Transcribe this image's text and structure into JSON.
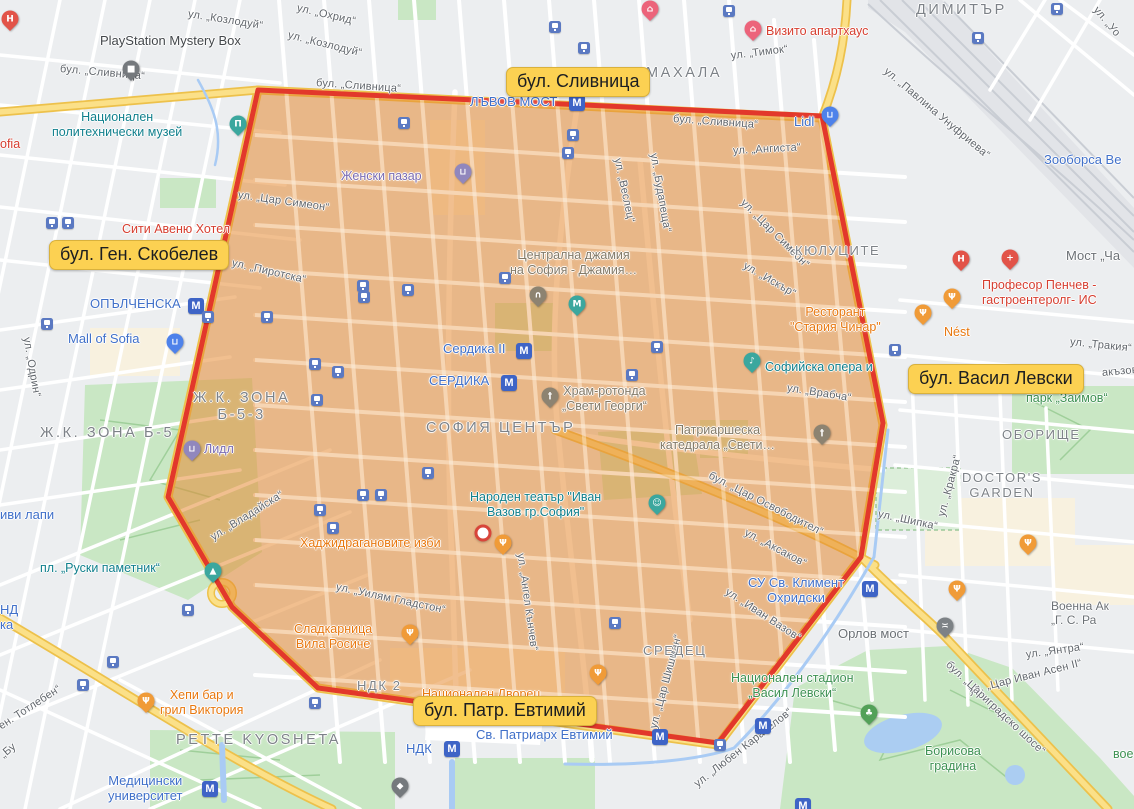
{
  "annotations": [
    {
      "id": "slivnitsa",
      "label": "бул. Сливница",
      "x": 506,
      "y": 67
    },
    {
      "id": "skobelev",
      "label": "бул. Ген. Скобелев",
      "x": 49,
      "y": 240
    },
    {
      "id": "vasil-levski",
      "label": "бул. Васил Левски",
      "x": 908,
      "y": 364
    },
    {
      "id": "patr-evtimiy",
      "label": "бул. Патр. Евтимий",
      "x": 413,
      "y": 696
    }
  ],
  "map": {
    "zone": {
      "points": "258,90 822,116 883,423 861,557 718,743 318,688 232,607 168,497",
      "fill": "rgba(230,139,51,0.55)",
      "stroke": "#e2382b",
      "stroke_width": 5
    },
    "marker": {
      "x": 483,
      "y": 533
    },
    "labels": [
      {
        "t": "ул. „Козлодуй“",
        "x": 188,
        "y": 8,
        "c": "st",
        "r": 9
      },
      {
        "t": "ул. „Козлодуй“",
        "x": 288,
        "y": 29,
        "c": "st",
        "r": 14
      },
      {
        "t": "ул. „Охрид“",
        "x": 297,
        "y": 2,
        "c": "st",
        "r": 13
      },
      {
        "t": "бул. „Сливница“",
        "x": 60,
        "y": 63,
        "c": "st",
        "r": 5
      },
      {
        "t": "бул. „Сливница“",
        "x": 316,
        "y": 77,
        "c": "st",
        "r": 4
      },
      {
        "t": "бул. „Сливница“",
        "x": 673,
        "y": 113,
        "c": "st",
        "r": 4
      },
      {
        "t": "ул. „Тимок“",
        "x": 731,
        "y": 50,
        "c": "st",
        "r": -7
      },
      {
        "t": "ул. „Павлина Унуфриева“",
        "x": 885,
        "y": 64,
        "c": "st",
        "r": 40
      },
      {
        "t": "ул. „Уо",
        "x": 1095,
        "y": 2,
        "c": "st",
        "r": 50
      },
      {
        "t": "ул. „Ангиста“",
        "x": 733,
        "y": 145,
        "c": "st",
        "r": -3
      },
      {
        "t": "ул. „Веслец“",
        "x": 617,
        "y": 152,
        "c": "st",
        "r": 78
      },
      {
        "t": "ул. „Будапеща“",
        "x": 653,
        "y": 147,
        "c": "st",
        "r": 80
      },
      {
        "t": "ул. „Цар Симеон“",
        "x": 238,
        "y": 189,
        "c": "st",
        "r": 8
      },
      {
        "t": "ул. „Цар Симеон“",
        "x": 742,
        "y": 195,
        "c": "st",
        "r": 45
      },
      {
        "t": "ул. „Пиротска“",
        "x": 232,
        "y": 257,
        "c": "st",
        "r": 13
      },
      {
        "t": "ул. „Одрин“",
        "x": 26,
        "y": 331,
        "c": "st",
        "r": 80
      },
      {
        "t": "ул. „Искър“",
        "x": 744,
        "y": 259,
        "c": "st",
        "r": 30
      },
      {
        "t": "ул. „Врабча“",
        "x": 787,
        "y": 382,
        "c": "st",
        "r": 9
      },
      {
        "t": "ул. „Тракия“",
        "x": 1070,
        "y": 336,
        "c": "st",
        "r": 6
      },
      {
        "t": "ул. „Кракра“",
        "x": 942,
        "y": 510,
        "c": "st",
        "r": -75
      },
      {
        "t": "ул. „Шипка“",
        "x": 878,
        "y": 508,
        "c": "st",
        "r": 12
      },
      {
        "t": "бул. „Цар Освободител“",
        "x": 709,
        "y": 469,
        "c": "st",
        "r": 27
      },
      {
        "t": "ул. „Аксаков“",
        "x": 745,
        "y": 526,
        "c": "st",
        "r": 28
      },
      {
        "t": "ул. „Иван Вазов“",
        "x": 726,
        "y": 585,
        "c": "st",
        "r": 33
      },
      {
        "t": "ул. „Цар Шишман“",
        "x": 654,
        "y": 722,
        "c": "st",
        "r": -75
      },
      {
        "t": "ул. „Ангел Кънчев“",
        "x": 520,
        "y": 547,
        "c": "st",
        "r": 82
      },
      {
        "t": "ул. „Уилям Гладстон“",
        "x": 336,
        "y": 581,
        "c": "st",
        "r": 12
      },
      {
        "t": "ул. „Владайска“",
        "x": 212,
        "y": 532,
        "c": "st",
        "r": -32
      },
      {
        "t": "ул. „Янтра“",
        "x": 1026,
        "y": 649,
        "c": "st",
        "r": -8
      },
      {
        "t": "ул. „Цар Иван Асен II“",
        "x": 969,
        "y": 685,
        "c": "st",
        "r": -14
      },
      {
        "t": "бул. „Цариградско шосе“",
        "x": 947,
        "y": 657,
        "c": "st",
        "r": 43
      },
      {
        "t": "ул. „Любен Каравелов“",
        "x": 696,
        "y": 779,
        "c": "st",
        "r": -38
      },
      {
        "t": "ен. Тотлебен“",
        "x": 0,
        "y": 721,
        "c": "st",
        "r": -33
      },
      {
        "t": "„Бу",
        "x": 2,
        "y": 750,
        "c": "st",
        "r": -40
      },
      {
        "t": "акъзов“",
        "x": 1102,
        "y": 367,
        "c": "st",
        "r": -5
      },
      {
        "t": "МАХАЛА",
        "x": 646,
        "y": 65,
        "c": "dist-lg"
      },
      {
        "t": "ДИМИТЪР",
        "x": 916,
        "y": 2,
        "c": "dist-lg"
      },
      {
        "t": "КЮЛУЦИТЕ",
        "x": 795,
        "y": 243,
        "c": "dist"
      },
      {
        "t": "Ж.К. ЗОНА\nБ-5-3",
        "x": 193,
        "y": 390,
        "c": "dist-lg ctr"
      },
      {
        "t": "Ж.К. ЗОНА Б-5",
        "x": 40,
        "y": 425,
        "c": "dist-lg"
      },
      {
        "t": "СОФИЯ ЦЕНТЪР",
        "x": 426,
        "y": 420,
        "c": "dist-lg"
      },
      {
        "t": "СРЕДЕЦ",
        "x": 643,
        "y": 643,
        "c": "dist"
      },
      {
        "t": "PETTE KYOSHETA",
        "x": 176,
        "y": 732,
        "c": "dist-lg"
      },
      {
        "t": "ОБОРИЩЕ",
        "x": 1002,
        "y": 427,
        "c": "dist"
      },
      {
        "t": "DOCTOR'S\nGARDEN",
        "x": 962,
        "y": 470,
        "c": "dist ctr"
      },
      {
        "t": "НДК 2",
        "x": 357,
        "y": 678,
        "c": "dist"
      },
      {
        "t": "Национален\nполитехнически музей",
        "x": 52,
        "y": 110,
        "c": "teal ctr",
        "poi": true
      },
      {
        "t": "пл. „Руски паметник“",
        "x": 40,
        "y": 561,
        "c": "teal",
        "poi": true
      },
      {
        "t": "Народен театър \"Иван\nВазов гр.София\"",
        "x": 470,
        "y": 490,
        "c": "teal ctr",
        "poi": true
      },
      {
        "t": "Софийска опера и",
        "x": 765,
        "y": 360,
        "c": "teal",
        "poi": true
      },
      {
        "t": "Зооборса Ве",
        "x": 1044,
        "y": 152,
        "c": "blue",
        "poi": true
      },
      {
        "t": "ЛЪВОВ МОСТ",
        "x": 470,
        "y": 94,
        "c": "blue",
        "poi": true
      },
      {
        "t": "ОПЪЛЧЕНСКА",
        "x": 90,
        "y": 296,
        "c": "blue",
        "poi": true
      },
      {
        "t": "Сердика II",
        "x": 443,
        "y": 341,
        "c": "blue",
        "poi": true
      },
      {
        "t": "СЕРДИКА",
        "x": 429,
        "y": 373,
        "c": "blue",
        "poi": true
      },
      {
        "t": "Mall of Sofia",
        "x": 68,
        "y": 331,
        "c": "blue",
        "poi": true
      },
      {
        "t": "СУ Св. Климент\nОхридски",
        "x": 748,
        "y": 575,
        "c": "blue ctr",
        "poi": true
      },
      {
        "t": "Медицински\nуниверситет",
        "x": 108,
        "y": 773,
        "c": "blue ctr",
        "poi": true
      },
      {
        "t": "НДК",
        "x": 406,
        "y": 741,
        "c": "blue",
        "poi": true
      },
      {
        "t": "иви лапи",
        "x": 0,
        "y": 507,
        "c": "blue",
        "poi": true
      },
      {
        "t": "НД",
        "x": 0,
        "y": 602,
        "c": "blue",
        "poi": true
      },
      {
        "t": "ка",
        "x": 0,
        "y": 617,
        "c": "blue",
        "poi": true
      },
      {
        "t": "Св. Патриарх Евтимий",
        "x": 476,
        "y": 727,
        "c": "blue",
        "poi": true
      },
      {
        "t": "Lidl",
        "x": 794,
        "y": 114,
        "c": "blue",
        "poi": true
      },
      {
        "t": "Женски пазар",
        "x": 341,
        "y": 169,
        "c": "purple",
        "poi": true
      },
      {
        "t": "Лидл",
        "x": 204,
        "y": 442,
        "c": "purple",
        "poi": true
      },
      {
        "t": "Ресторант\n\"Стария Чинар\"",
        "x": 790,
        "y": 305,
        "c": "orange ctr",
        "poi": true
      },
      {
        "t": "Nést",
        "x": 944,
        "y": 325,
        "c": "orange",
        "poi": true
      },
      {
        "t": "Хаджидрагановите изби",
        "x": 300,
        "y": 536,
        "c": "orange",
        "poi": true
      },
      {
        "t": "Сладкарница\nВила Росиче",
        "x": 294,
        "y": 622,
        "c": "orange ctr",
        "poi": true
      },
      {
        "t": "Хепи бар и\nгрил Виктория",
        "x": 160,
        "y": 688,
        "c": "orange ctr",
        "poi": true
      },
      {
        "t": "Национален Дворец",
        "x": 422,
        "y": 687,
        "c": "orange",
        "poi": true
      },
      {
        "t": "Сити Авеню Хотел",
        "x": 122,
        "y": 222,
        "c": "red",
        "poi": true
      },
      {
        "t": "Визито апартхаус",
        "x": 766,
        "y": 24,
        "c": "red",
        "poi": true
      },
      {
        "t": "Професор Пенчев -\nгастроентеролг- ИС",
        "x": 982,
        "y": 278,
        "c": "red",
        "poi": true
      },
      {
        "t": "ofia",
        "x": 0,
        "y": 137,
        "c": "red",
        "poi": true
      },
      {
        "t": "парк „Заимов“",
        "x": 1026,
        "y": 391,
        "c": "green",
        "poi": true
      },
      {
        "t": "Национален стадион\n„Васил Левски“",
        "x": 731,
        "y": 671,
        "c": "green ctr",
        "poi": true
      },
      {
        "t": "Борисова\nградина",
        "x": 925,
        "y": 744,
        "c": "green ctr",
        "poi": true
      },
      {
        "t": "вое",
        "x": 1113,
        "y": 747,
        "c": "green",
        "poi": true
      },
      {
        "t": "PlayStation Mystery Box",
        "x": 100,
        "y": 33,
        "c": "dark",
        "poi": true
      },
      {
        "t": "Централна джамия\nна София - Джамия…",
        "x": 510,
        "y": 248,
        "c": "gray ctr",
        "poi": true
      },
      {
        "t": "Храм-ротонда\n„Свети Георги“",
        "x": 562,
        "y": 384,
        "c": "gray ctr",
        "poi": true
      },
      {
        "t": "Патриаршеска\nкатедрала „Свети…",
        "x": 660,
        "y": 423,
        "c": "gray ctr",
        "poi": true
      },
      {
        "t": "Орлов мост",
        "x": 838,
        "y": 626,
        "c": "slate-lg",
        "poi": true
      },
      {
        "t": "Мост „Ча",
        "x": 1066,
        "y": 248,
        "c": "slate-lg",
        "poi": true
      },
      {
        "t": "Военна Ак\n„Г. С. Ра",
        "x": 1051,
        "y": 599,
        "c": "slate",
        "poi": true
      }
    ],
    "pin_kinds": {
      "hospital": {
        "color": "#e25348",
        "glyph": "H"
      },
      "clinic": {
        "color": "#e25348",
        "glyph": "+"
      },
      "hotel": {
        "color": "#ec647b",
        "glyph": "⌂"
      },
      "museum": {
        "color": "#3ba79e",
        "glyph": "Π"
      },
      "metro-entrance": {
        "color": "#3ba79e",
        "glyph": "М"
      },
      "monument": {
        "color": "#3ba79e",
        "glyph": "▲"
      },
      "theater": {
        "color": "#3ba79e",
        "glyph": "☺"
      },
      "music": {
        "color": "#3ba79e",
        "glyph": "♪"
      },
      "mosque": {
        "color": "#8d8371",
        "glyph": "∩"
      },
      "church": {
        "color": "#8d8371",
        "glyph": "†"
      },
      "restaurant": {
        "color": "#f09b38",
        "glyph": "Ψ"
      },
      "market": {
        "color": "#9187bd",
        "glyph": "⊔"
      },
      "supermarket": {
        "color": "#4e82ea",
        "glyph": "⊔"
      },
      "mall": {
        "color": "#4e82ea",
        "glyph": "⊔"
      },
      "bridge": {
        "color": "#7d8286",
        "glyph": "≍"
      },
      "park": {
        "color": "#53a158",
        "glyph": "♣"
      },
      "shop": {
        "color": "#75797d",
        "glyph": "■"
      },
      "university": {
        "color": "#75797d",
        "glyph": "◆"
      }
    },
    "pins": [
      {
        "k": "hospital",
        "x": 10,
        "y": 22
      },
      {
        "k": "hospital",
        "x": 961,
        "y": 262
      },
      {
        "k": "clinic",
        "x": 1010,
        "y": 261
      },
      {
        "k": "hotel",
        "x": 753,
        "y": 32
      },
      {
        "k": "hotel",
        "x": 650,
        "y": 12
      },
      {
        "k": "museum",
        "x": 238,
        "y": 127
      },
      {
        "k": "metro-entrance",
        "x": 577,
        "y": 307
      },
      {
        "k": "monument",
        "x": 213,
        "y": 574
      },
      {
        "k": "theater",
        "x": 657,
        "y": 506
      },
      {
        "k": "music",
        "x": 752,
        "y": 364
      },
      {
        "k": "mosque",
        "x": 538,
        "y": 298
      },
      {
        "k": "church",
        "x": 550,
        "y": 399
      },
      {
        "k": "church",
        "x": 822,
        "y": 436
      },
      {
        "k": "restaurant",
        "x": 923,
        "y": 316
      },
      {
        "k": "restaurant",
        "x": 952,
        "y": 300
      },
      {
        "k": "restaurant",
        "x": 503,
        "y": 546
      },
      {
        "k": "restaurant",
        "x": 410,
        "y": 636
      },
      {
        "k": "restaurant",
        "x": 146,
        "y": 704
      },
      {
        "k": "restaurant",
        "x": 598,
        "y": 676
      },
      {
        "k": "restaurant",
        "x": 1028,
        "y": 546
      },
      {
        "k": "restaurant",
        "x": 957,
        "y": 592
      },
      {
        "k": "market",
        "x": 463,
        "y": 175
      },
      {
        "k": "market",
        "x": 192,
        "y": 452
      },
      {
        "k": "supermarket",
        "x": 830,
        "y": 118
      },
      {
        "k": "mall",
        "x": 175,
        "y": 345
      },
      {
        "k": "bridge",
        "x": 945,
        "y": 629
      },
      {
        "k": "park",
        "x": 869,
        "y": 716
      },
      {
        "k": "shop",
        "x": 131,
        "y": 72
      },
      {
        "k": "university",
        "x": 400,
        "y": 789
      }
    ],
    "metro_badges": [
      [
        577,
        103
      ],
      [
        196,
        306
      ],
      [
        524,
        351
      ],
      [
        509,
        383
      ],
      [
        870,
        589
      ],
      [
        660,
        737
      ],
      [
        452,
        749
      ],
      [
        763,
        726
      ],
      [
        210,
        789
      ],
      [
        803,
        806
      ]
    ],
    "tram_stops": [
      [
        404,
        123
      ],
      [
        555,
        27
      ],
      [
        584,
        48
      ],
      [
        729,
        11
      ],
      [
        978,
        38
      ],
      [
        1057,
        9
      ],
      [
        573,
        135
      ],
      [
        568,
        153
      ],
      [
        52,
        223
      ],
      [
        68,
        223
      ],
      [
        47,
        324
      ],
      [
        208,
        317
      ],
      [
        267,
        317
      ],
      [
        363,
        286
      ],
      [
        364,
        297
      ],
      [
        315,
        364
      ],
      [
        338,
        372
      ],
      [
        317,
        400
      ],
      [
        408,
        290
      ],
      [
        505,
        278
      ],
      [
        657,
        347
      ],
      [
        632,
        375
      ],
      [
        895,
        350
      ],
      [
        428,
        473
      ],
      [
        363,
        495
      ],
      [
        381,
        495
      ],
      [
        320,
        510
      ],
      [
        333,
        528
      ],
      [
        615,
        623
      ],
      [
        188,
        610
      ],
      [
        113,
        662
      ],
      [
        83,
        685
      ],
      [
        315,
        703
      ],
      [
        720,
        745
      ]
    ]
  }
}
